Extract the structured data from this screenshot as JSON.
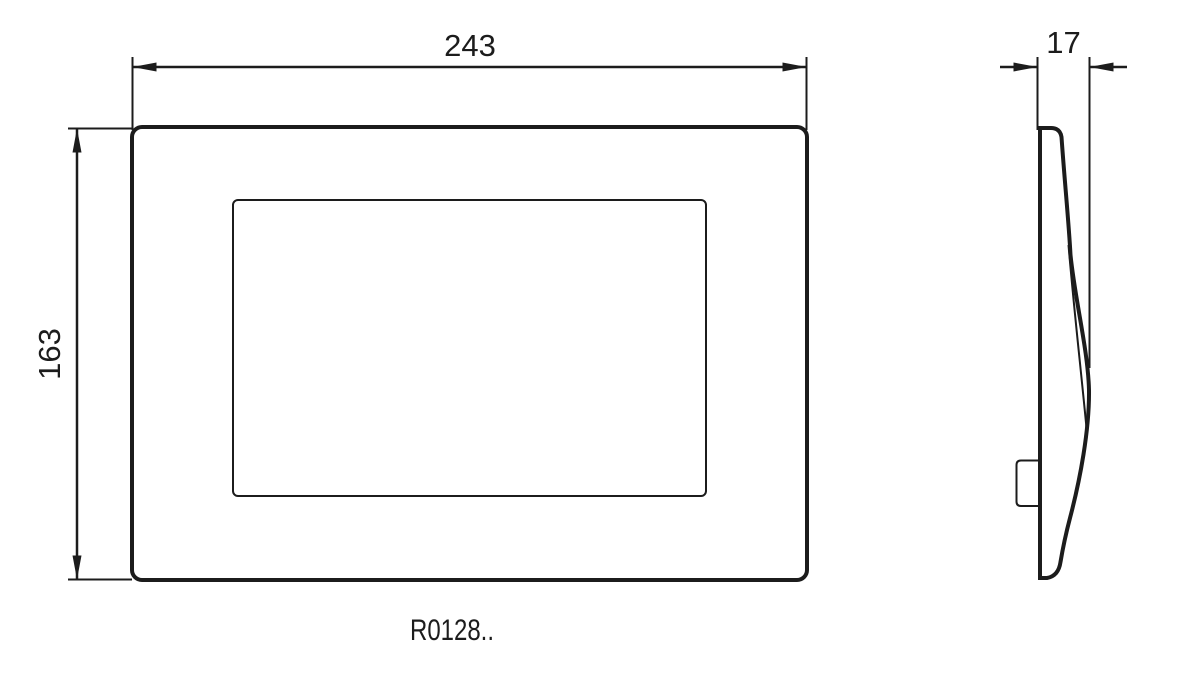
{
  "colors": {
    "line": "#1c1c1c",
    "background": "#ffffff"
  },
  "drawing": {
    "product_code": "R0128..",
    "dimensions": {
      "width": "243",
      "height": "163",
      "depth": "17"
    }
  }
}
